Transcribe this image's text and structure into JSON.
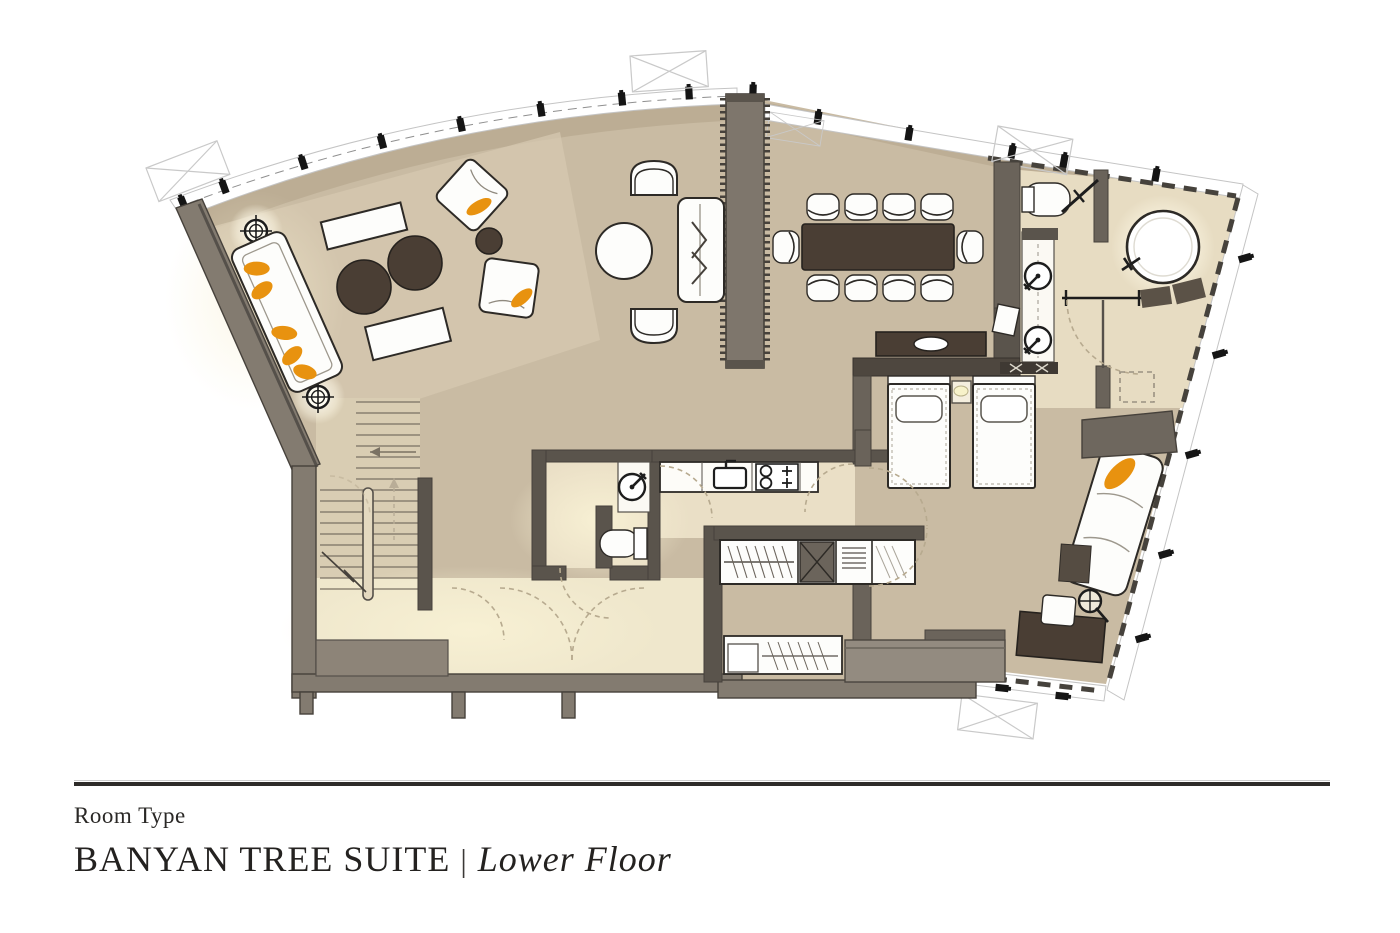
{
  "title_block": {
    "label": "Room Type",
    "suite_name": "BANYAN TREE SUITE",
    "separator": "|",
    "floor_label": "Lower Floor"
  },
  "palette": {
    "background": "#ffffff",
    "floor": "#c9bba3",
    "floor_light": "#e9dfc6",
    "floor_glow": "#f4ecd2",
    "wall_fill": "#837b70",
    "wall_stroke": "#46413b",
    "wall_dark": "#5a544c",
    "outline": "#2d2a26",
    "furniture_dark": "#4a3e34",
    "accent_orange": "#e8920f",
    "window_line": "#c4c4c4",
    "dash_dark": "#46423c",
    "door_arc": "#b7aa8f",
    "text": "#262422"
  },
  "floor_plan": {
    "type": "architectural-floor-plan",
    "features": [
      "curved-window-wall",
      "sofa",
      "armchairs",
      "coffee-tables",
      "ceiling-lights",
      "tv-partition-wall",
      "lounge-chairs",
      "round-table",
      "loveseat",
      "dining-table-ten-chairs",
      "console-table",
      "staircase",
      "entry-corridor",
      "kitchen-counter",
      "kitchen-sink",
      "stove",
      "powder-room-sink",
      "powder-room-toilet",
      "wardrobe",
      "luggage-closet",
      "safe",
      "twin-beds",
      "nightstand",
      "dresser",
      "bathroom-round-bathtub",
      "bathroom-toilet",
      "double-vanity-sinks",
      "chaise-lounge",
      "side-table",
      "desk",
      "desk-chair",
      "door-swings"
    ]
  }
}
